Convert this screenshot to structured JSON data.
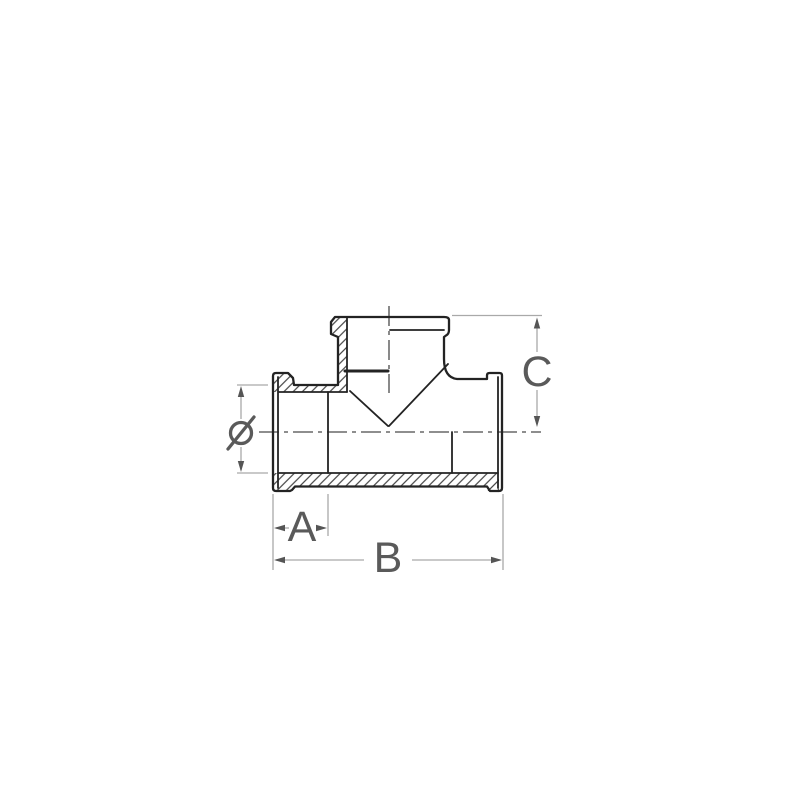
{
  "page": {
    "background_color": "#ffffff",
    "title": "Threaded tee fitting dimensional drawing"
  },
  "drawing": {
    "subject": "tee-pipe-fitting-half-section",
    "view": "front view, half section with hatched walls",
    "dimensions": [
      {
        "id": "diameter",
        "label": "Ø",
        "orientation": "vertical",
        "position": "left"
      },
      {
        "id": "a",
        "label": "A",
        "orientation": "horizontal",
        "position": "bottom-left"
      },
      {
        "id": "b",
        "label": "B",
        "orientation": "horizontal",
        "position": "bottom"
      },
      {
        "id": "c",
        "label": "C",
        "orientation": "vertical",
        "position": "right"
      }
    ],
    "colors": {
      "outline": "#232323",
      "inner_line": "#2b2b2b",
      "hatch": "#2a2a2a",
      "centerline": "#4a4a4a",
      "dimension_line": "#a9a9a9",
      "dimension_text": "#5a5a5a",
      "arrow": "#555555"
    }
  }
}
